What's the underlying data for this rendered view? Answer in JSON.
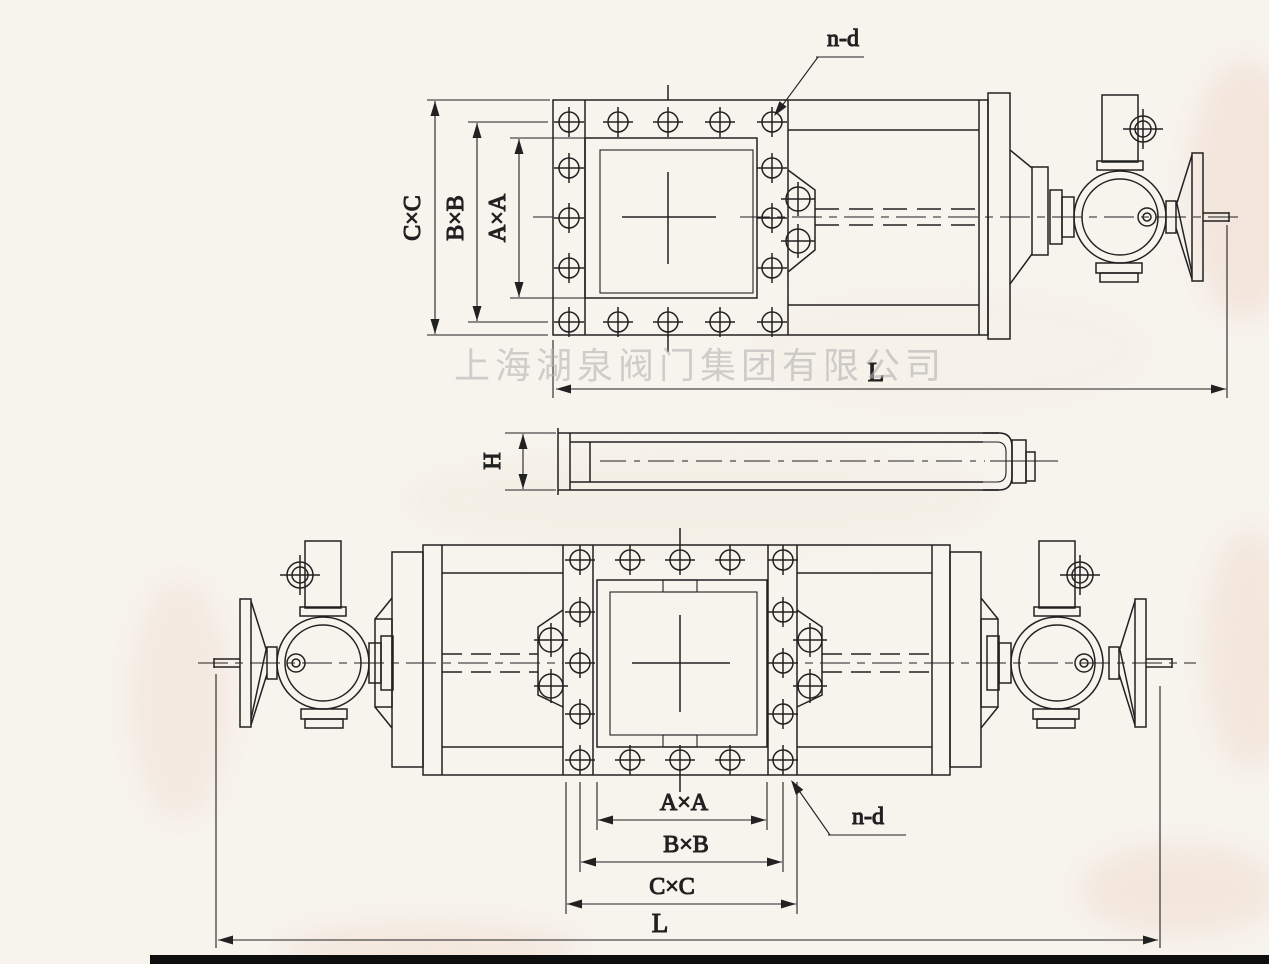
{
  "watermark": "上海湖泉阀门集团有限公司",
  "views": {
    "top": {
      "dim_c": "C×C",
      "dim_b": "B×B",
      "dim_a": "A×A",
      "bolt_note": "n-d",
      "length": "L"
    },
    "section": {
      "height": "H"
    },
    "bottom": {
      "dim_a": "A×A",
      "dim_b": "B×B",
      "dim_c": "C×C",
      "bolt_note": "n-d",
      "length": "L"
    }
  },
  "colors": {
    "paper": "#f7f4ee",
    "ink": "#212121",
    "watermark": "#b3b3b3",
    "stain": "#f0d9cc",
    "edge": "#0e0e0e"
  }
}
